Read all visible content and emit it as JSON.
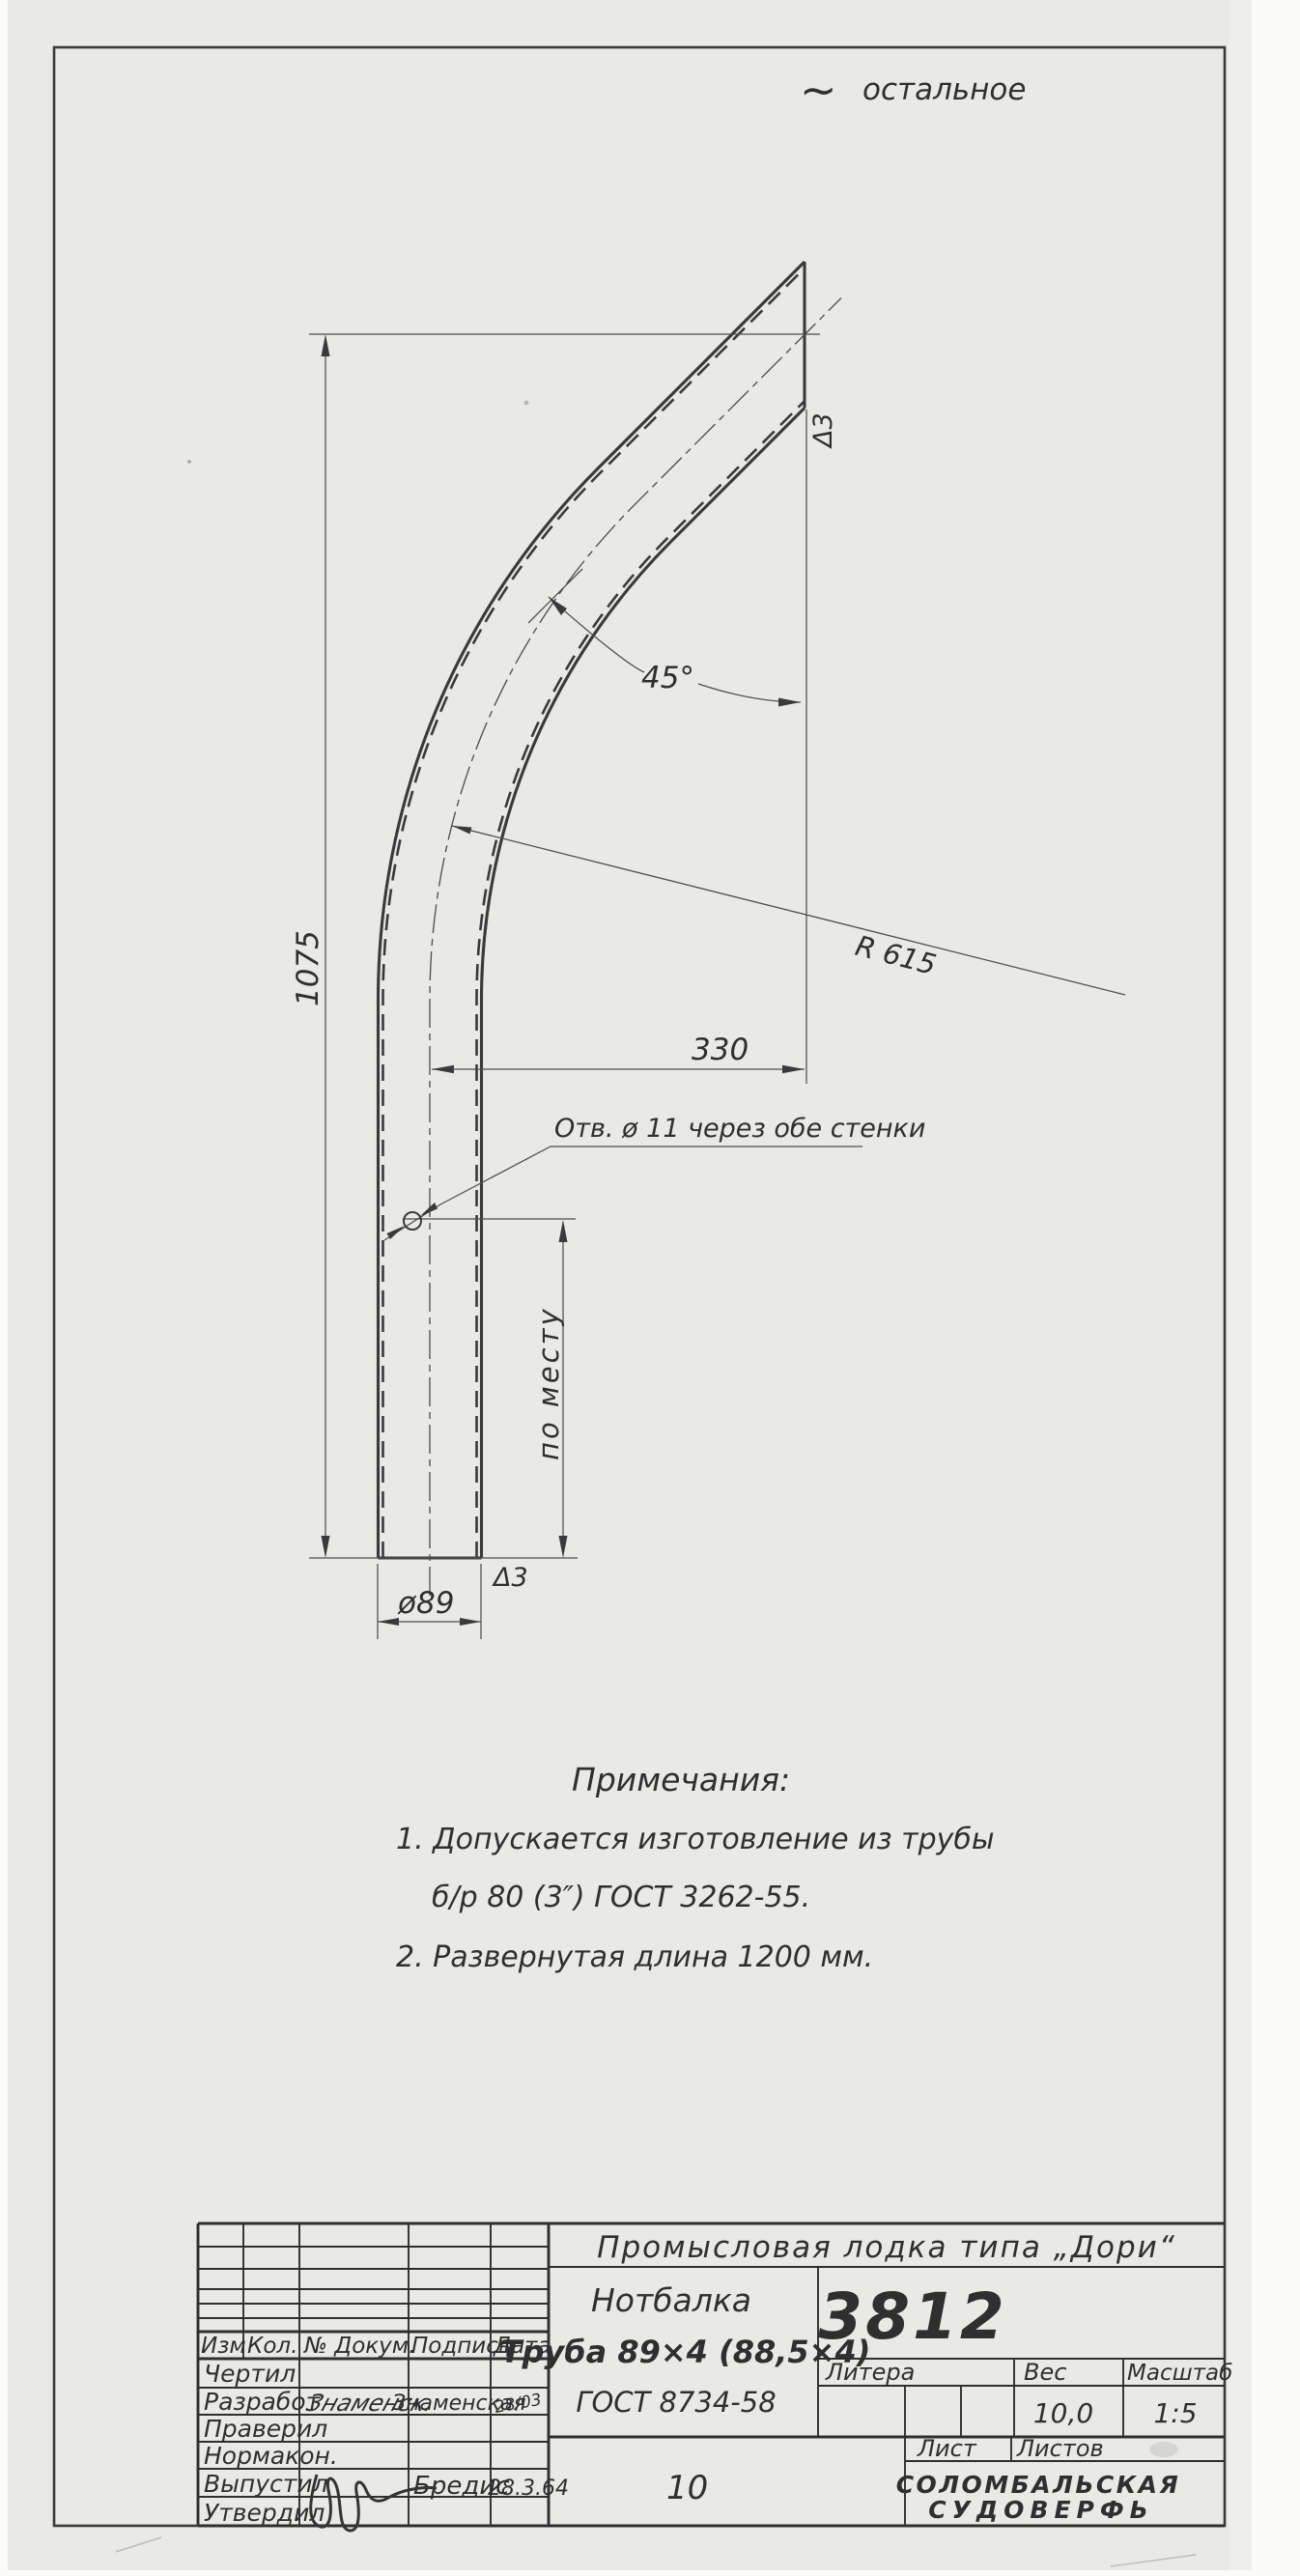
{
  "annotations": {
    "roughness_symbol": "∼",
    "roughness_text": "остальное",
    "dim_1075": "1075",
    "dim_45": "45°",
    "dim_r615": "R 615",
    "dim_330": "330",
    "hole_note": "Отв. ø 11 через обе стенки",
    "dim_po_mestu": "по месту",
    "finish_top": "Δ3",
    "finish_bottom": "Δ3",
    "dim_dia89": "ø89"
  },
  "notes": {
    "title": "Примечания:",
    "line1": "1. Допускается  изготовление  из трубы",
    "line2": "б/р  80 (3″)    ГОСТ 3262-55.",
    "line3": "2. Развернутая  длина   1200 мм."
  },
  "title_block": {
    "project": "Промысловая  лодка  типа  „Дори“",
    "part_name": "Нотбалка",
    "part_spec": "Труба 89×4 (88,5×4)",
    "part_gost": "ГОСТ 8734-58",
    "drawing_number": "3812",
    "litera_label": "Литера",
    "weight_label": "Вес",
    "weight_value": "10,0",
    "scale_label": "Масштаб",
    "scale_value": "1:5",
    "sheet_label": "Лист",
    "sheets_label": "Листов",
    "sheet_number": "10",
    "company_line1": "СОЛОМБАЛЬСКАЯ",
    "company_line2": "СУДОВЕРФЬ",
    "columns": [
      "Изм",
      "Кол.",
      "№ Докум.",
      "Подпись",
      "Дата"
    ],
    "rows": [
      {
        "label": "Чертил",
        "sig": "",
        "name": "",
        "date": ""
      },
      {
        "label": "Разработ",
        "sig": "Знаменск.",
        "name": "Знаменская",
        "date": "28/03"
      },
      {
        "label": "Праверил",
        "sig": "",
        "name": "",
        "date": ""
      },
      {
        "label": "Нормакон.",
        "sig": "",
        "name": "",
        "date": ""
      },
      {
        "label": "Выпустил",
        "sig": "",
        "name": "Бредис",
        "date": "28.3.64"
      },
      {
        "label": "Утвердил",
        "sig": "",
        "name": "",
        "date": ""
      }
    ]
  }
}
